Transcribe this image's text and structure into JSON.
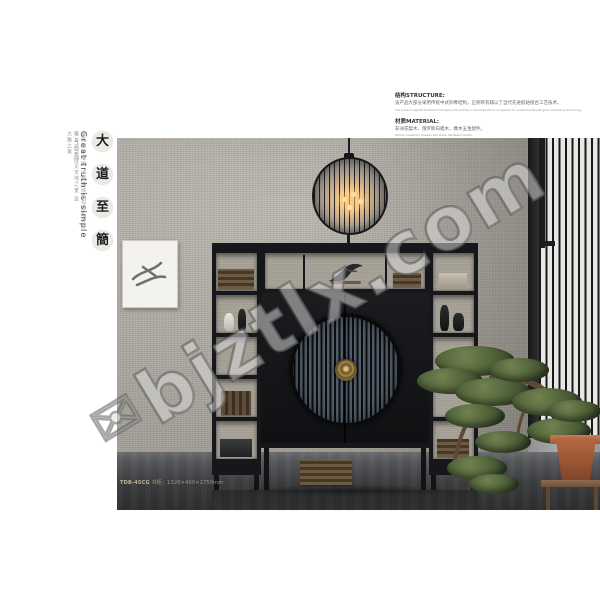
{
  "side": {
    "characters": [
      "大",
      "道",
      "至",
      "簡"
    ],
    "english_title": "Great truth is simple",
    "caption_col1": "摒弃繁复雕琢 以极简线条勾勒东方意境 气韵天成",
    "caption_col2": "于方寸之间 见天地之宽 显大雅之美"
  },
  "specs": {
    "structure_heading": "结构STRUCTURE:",
    "structure_cn": "该产品大部分采用传统中式卯榫结构，正侧带有辅以了当代先进胶粘接合工艺技术。",
    "structure_en": "The product applied traditional Chinese joint and tenon structure which is superior to current handmade glue connecting technology.",
    "material_heading": "材质MATERIAL:",
    "material_cn": "非洲花梨木、俄罗斯白蜡木，橡木五金配件。",
    "material_en": "African rosewood, Russian ash wood, hardware handle."
  },
  "product": {
    "code": "TDB-45CG",
    "spec": "书柜：1320×400×1750mm"
  },
  "watermark": {
    "icon": "✉",
    "text": "bjztlx.com"
  },
  "colors": {
    "wall": "#b2aea5",
    "floor": "#2e3032",
    "cabinet": "#16171a",
    "door_stripe": "#515c68",
    "brass": "#8d7540",
    "pot": "#9a5535"
  }
}
